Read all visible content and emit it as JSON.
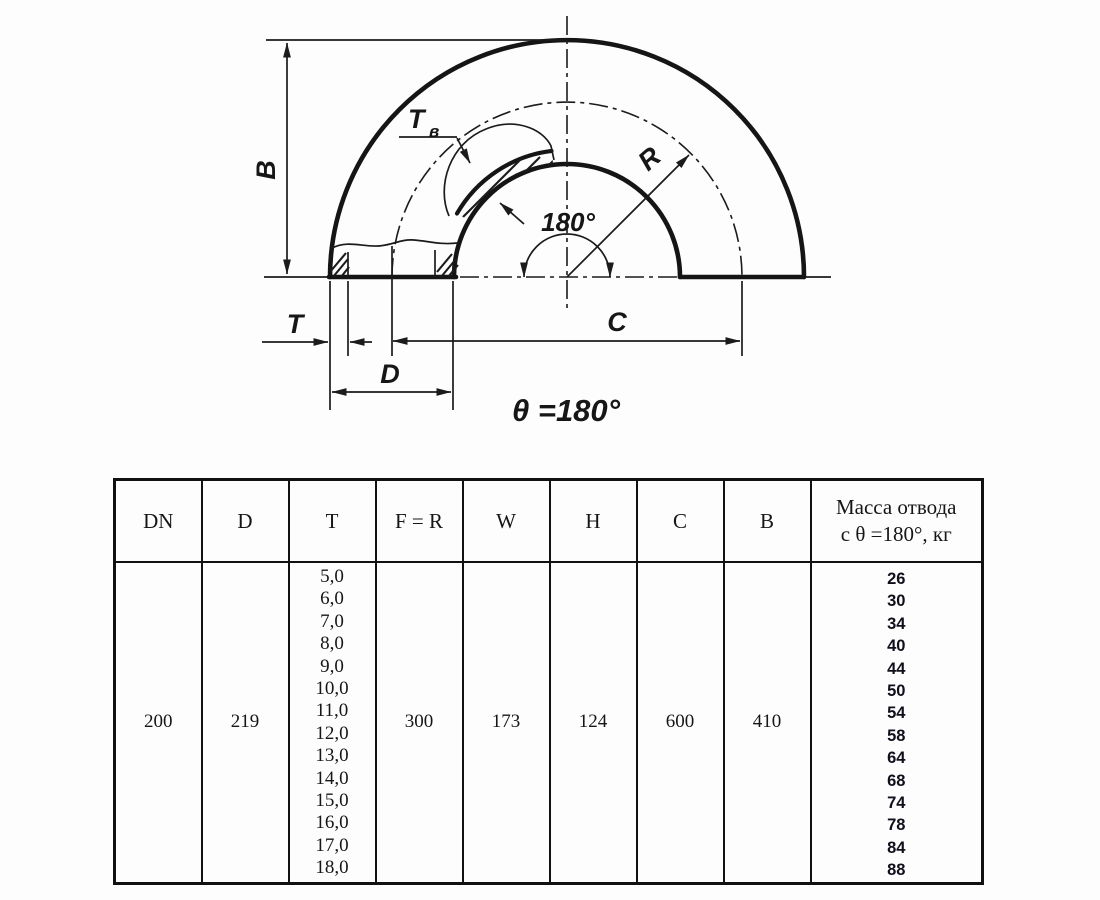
{
  "figure": {
    "dim_b": "B",
    "dim_t": "T",
    "dim_d": "D",
    "dim_c": "C",
    "dim_r": "R",
    "wall_label_main": "T",
    "wall_label_sub": "в",
    "angle_label": "180°",
    "theta_caption": "θ =180°"
  },
  "table": {
    "headers": [
      "DN",
      "D",
      "T",
      "F = R",
      "W",
      "H",
      "C",
      "B"
    ],
    "mass_header": [
      "Масса отвода",
      "с θ =180°, кг"
    ],
    "row": {
      "dn": "200",
      "d": "219",
      "t_values": [
        "5,0",
        "6,0",
        "7,0",
        "8,0",
        "9,0",
        "10,0",
        "11,0",
        "12,0",
        "13,0",
        "14,0",
        "15,0",
        "16,0",
        "17,0",
        "18,0"
      ],
      "f_r": "300",
      "w": "173",
      "h": "124",
      "c": "600",
      "b": "410",
      "mass_values": [
        "26",
        "30",
        "34",
        "40",
        "44",
        "50",
        "54",
        "58",
        "64",
        "68",
        "74",
        "78",
        "84",
        "88"
      ]
    }
  },
  "colors": {
    "line": "#1b1b1b",
    "mass_text": "#10101c",
    "background": "#fdfdfe"
  }
}
